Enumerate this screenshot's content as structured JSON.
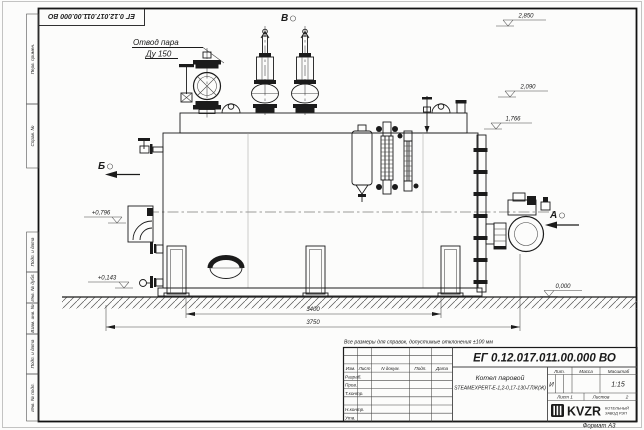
{
  "frame": {
    "side_stamps": [
      "Перв. примен.",
      "Справ. №",
      "Подп. и дата",
      "Инв. № дубл.",
      "Взам. инв. №",
      "Подп. и дата",
      "Инв. № подл."
    ],
    "format_label": "Формат А3"
  },
  "drawing": {
    "callout": {
      "line1": "Отвод пара",
      "line2": "Ду 150"
    },
    "views": {
      "a": "А",
      "b": "Б",
      "v": "В"
    },
    "elevations": {
      "top": "2,850",
      "drum": "2,090",
      "shell": "1,766",
      "inlet": "+0,796",
      "low": "+0,143",
      "ground": "0,000"
    },
    "dimensions": {
      "inner": "3400",
      "overall": "3750"
    },
    "note": "Все размеры для справок, допустимые отклонения ±100 мм"
  },
  "title_block": {
    "doc_number": "ЕГ 0.12.017.011.00.000  ВО",
    "product_name": "Котел паровой",
    "product_model": "STEAMEXPERT-Е-1,2-0,17-130-ГЛЖ(Ж)",
    "col_izm": "Изм.",
    "col_list": "Лист",
    "col_ndokum": "N докум.",
    "col_podp": "Подп.",
    "col_data": "Дата",
    "row_razrab": "Разраб.",
    "row_prov": "Пров.",
    "row_tkontr": "Т.контр.",
    "row_nkontr": "Н.контр.",
    "row_utv": "Утв.",
    "lit_header": "Лит.",
    "massa_header": "Масса",
    "masshtab_header": "Масштаб",
    "lit_value": "И",
    "scale_value": "1:15",
    "sheet_label": "Лист 1",
    "sheets_label": "Листов",
    "sheets_value": "2",
    "logo_text": "KVZR",
    "company_line1": "КОТЕЛЬНЫЙ",
    "company_line2": "ЗАВОД РЭП"
  }
}
